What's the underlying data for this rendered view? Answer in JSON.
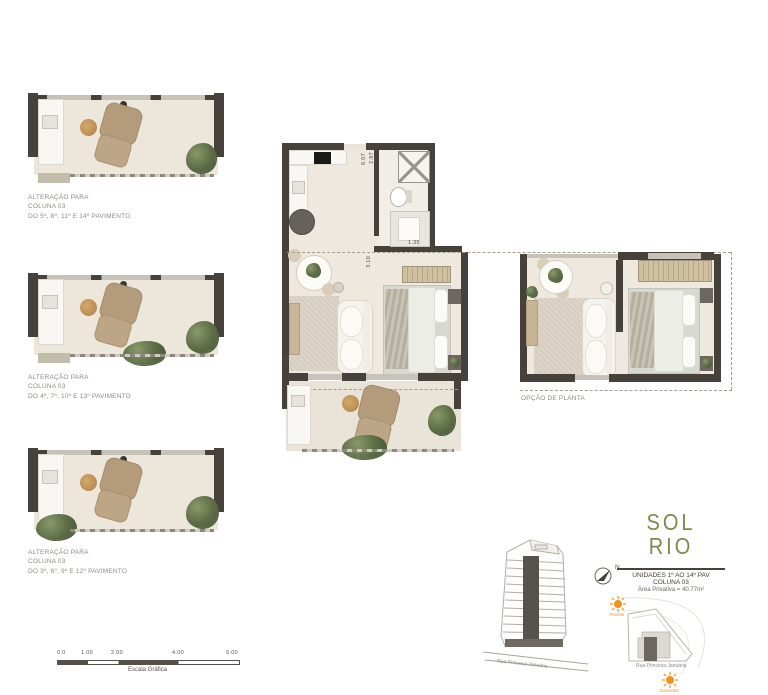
{
  "left_plans": [
    {
      "caption_line1": "ALTERAÇÃO PARA",
      "caption_line2": "COLUNA 03",
      "caption_line3": "DO 5º, 8º, 11º E 14º PAVIMENTO"
    },
    {
      "caption_line1": "ALTERAÇÃO PARA",
      "caption_line2": "COLUNA 03",
      "caption_line3": "DO 4º, 7º, 10º E 13º PAVIMENTO"
    },
    {
      "caption_line1": "ALTERAÇÃO PARA",
      "caption_line2": "COLUNA 03",
      "caption_line3": "DO 3º, 6º, 9º E 12º PAVIMENTO"
    }
  ],
  "central_plan": {
    "dims": {
      "top_width": "6.07",
      "bath_width": "2.87",
      "bath_height": "3.10",
      "bath_bottom": "1.35",
      "side_height": "5.11"
    }
  },
  "right_plan": {
    "caption": "OPÇÃO DE PLANTA"
  },
  "logo": {
    "line1": "SOL",
    "line2": "RIO",
    "color": "#7c8a4c"
  },
  "unit_info": {
    "line1": "UNIDADES 1º AO 14º PAV",
    "line2": "COLUNA 03",
    "line3": "Área Privativa = 40.77m²"
  },
  "compass": {
    "label": "N"
  },
  "site": {
    "sun_top_label": "Poente",
    "sun_bottom_label": "Nascente",
    "street": "Rua Princesa Januária",
    "sun_color": "#f0941f"
  },
  "elevation": {
    "street": "Rua Princesa Januária"
  },
  "scale_bar": {
    "labels": [
      "0.0",
      "1.00",
      "2.00",
      "4.00",
      "6.00"
    ],
    "caption": "Escala Gráfica"
  }
}
